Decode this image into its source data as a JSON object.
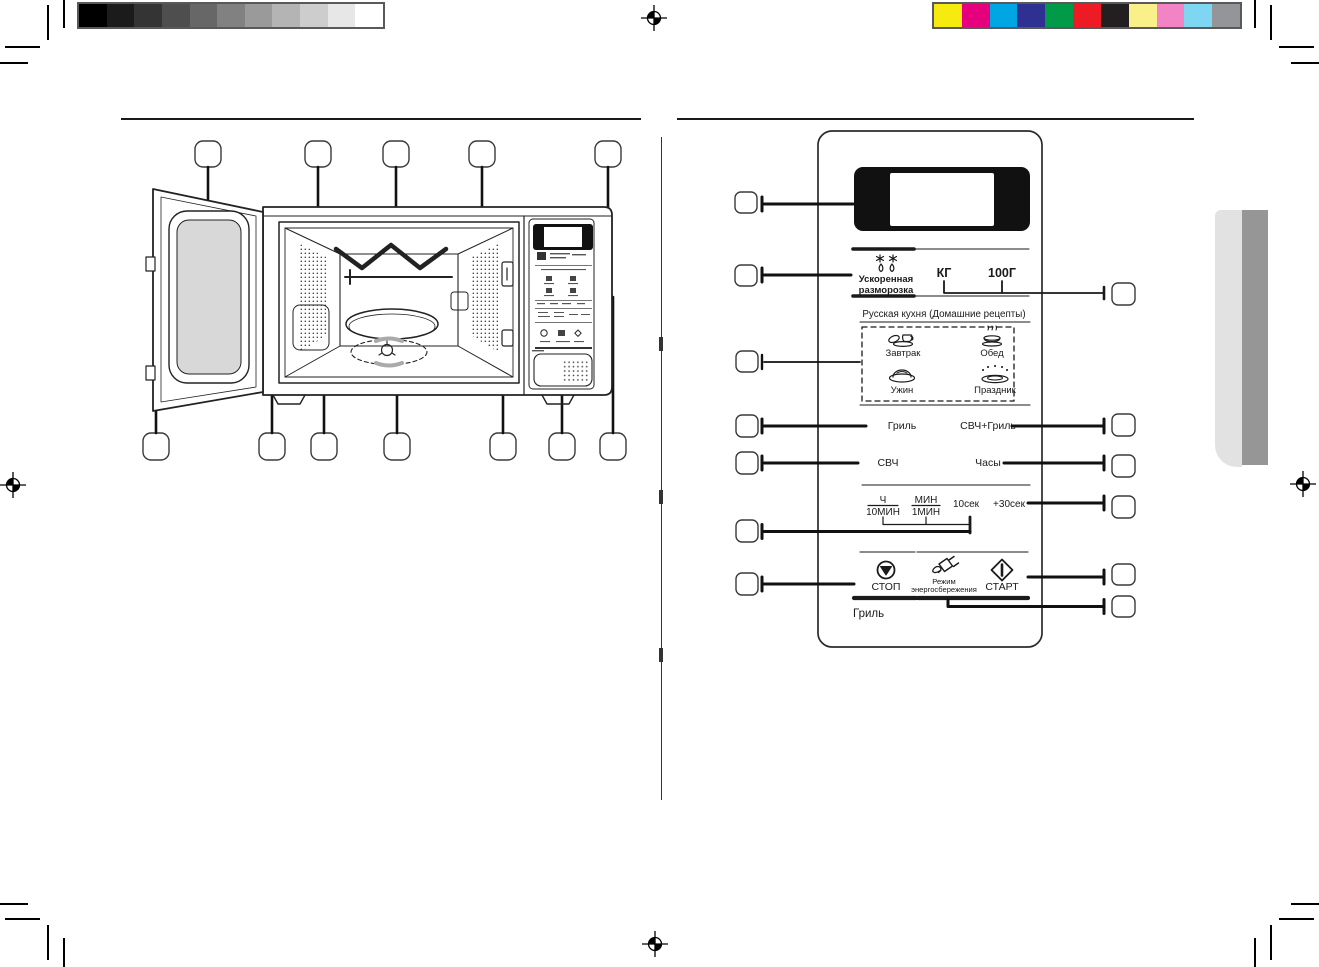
{
  "calibration": {
    "grayscale": [
      "#000000",
      "#1b1b1b",
      "#343434",
      "#4e4e4e",
      "#676767",
      "#818181",
      "#9a9a9a",
      "#b4b4b4",
      "#cdcdcd",
      "#e7e7e7",
      "#ffffff"
    ],
    "colors": [
      "#f6eb0e",
      "#e6007e",
      "#00a5e3",
      "#2e3192",
      "#009a49",
      "#ed1c24",
      "#231f20",
      "#f9f08a",
      "#f283c5",
      "#7fd6f3",
      "#939598"
    ]
  },
  "control_panel": {
    "accent_color": "#1a1a1a",
    "defrost_label_1": "Ускоренная",
    "defrost_label_2": "разморозка",
    "kg_label": "КГ",
    "g100_label": "100Г",
    "recipes_title": "Русская кухня (Домашние рецепты)",
    "recipe_breakfast": "Завтрак",
    "recipe_lunch": "Обед",
    "recipe_dinner": "Ужин",
    "recipe_holiday": "Праздник",
    "grill_label": "Гриль",
    "mw_grill_label": "СВЧ+Гриль",
    "mw_label": "СВЧ",
    "clock_label": "Часы",
    "hours_label": "Ч",
    "min10_label": "10МИН",
    "minutes_label": "МИН",
    "min1_label": "1МИН",
    "sec10_label": "10сек",
    "plus30_label": "+30сек",
    "stop_label": "СТОП",
    "eco_label_1": "Режим",
    "eco_label_2": "энергосбережения",
    "start_label": "СТАРТ",
    "panel_model_label": "Гриль",
    "icons": {
      "defrost": "snowflakes-drops-icon",
      "breakfast": "cup-croissant-icon",
      "lunch": "steaming-pot-icon",
      "dinner": "covered-dish-icon",
      "holiday": "festive-platter-icon",
      "stop": "circle-triangle-stop-icon",
      "energy_save": "power-plug-icon",
      "start": "diamond-start-icon"
    }
  }
}
